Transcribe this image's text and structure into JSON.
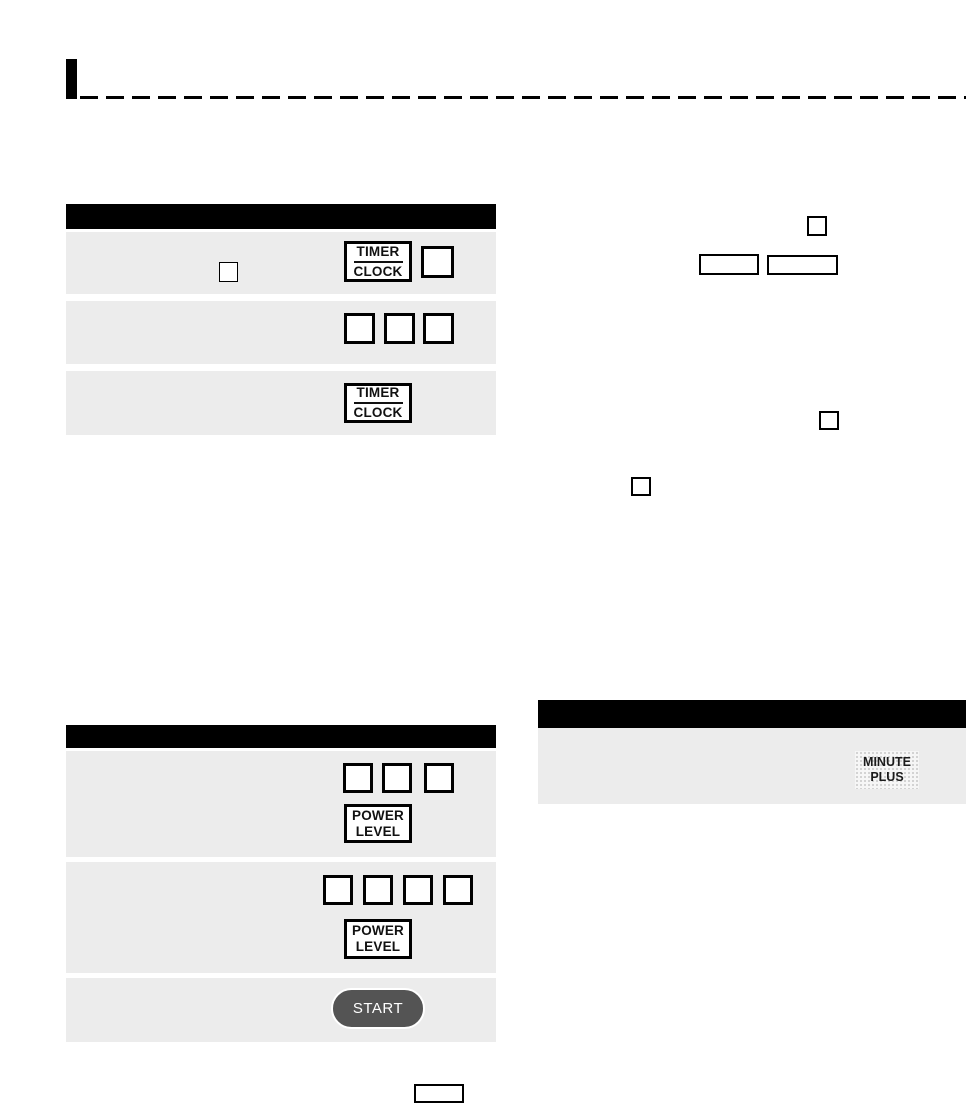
{
  "colors": {
    "page_bg": "#ffffff",
    "row_bg": "#ececec",
    "header_bar_bg": "#000000",
    "key_border": "#000000",
    "start_fill": "#545454",
    "start_text_color": "#ffffff",
    "minute_plus_dot_color": "#c7c7c7"
  },
  "buttons": {
    "timer_clock": {
      "top": "TIMER",
      "bottom": "CLOCK"
    },
    "power_level": {
      "top": "POWER",
      "bottom": "LEVEL"
    },
    "start": {
      "label": "START"
    },
    "minute_plus": {
      "top": "MINUTE",
      "bottom": "PLUS"
    }
  }
}
